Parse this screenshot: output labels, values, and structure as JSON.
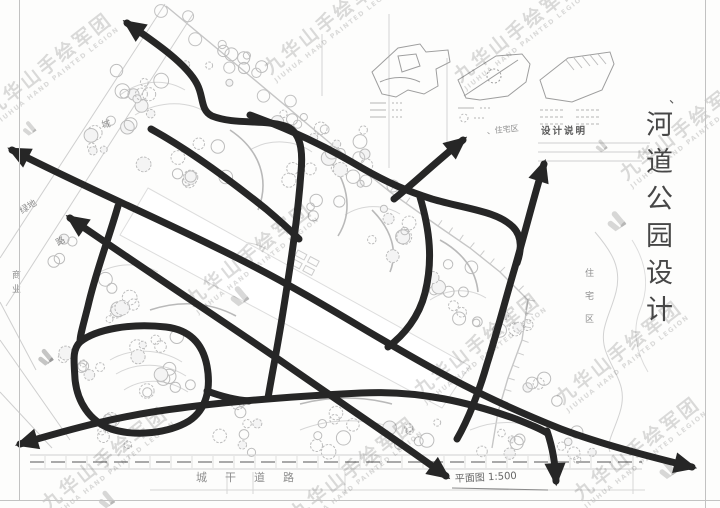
{
  "document": {
    "orientation_mark": "、",
    "title": "河道公园设计",
    "design_note_heading": "设计说明",
    "scale_note": "平面图 1:500"
  },
  "watermark": {
    "cn": "九华山手绘军团",
    "en": "JIUHUA HAND PAINTED LEGION"
  },
  "site_labels": {
    "west_road_top": "城",
    "green_space": "绿地",
    "west_road": "路",
    "commercial": "商业",
    "residential_center": "、住宅区",
    "residential_east": "住宅区",
    "city_main_road": "城干道路"
  },
  "colors": {
    "arrow_ink": "#262626",
    "pencil": "#c9c9c9",
    "label_ink": "#8e8e8e"
  }
}
